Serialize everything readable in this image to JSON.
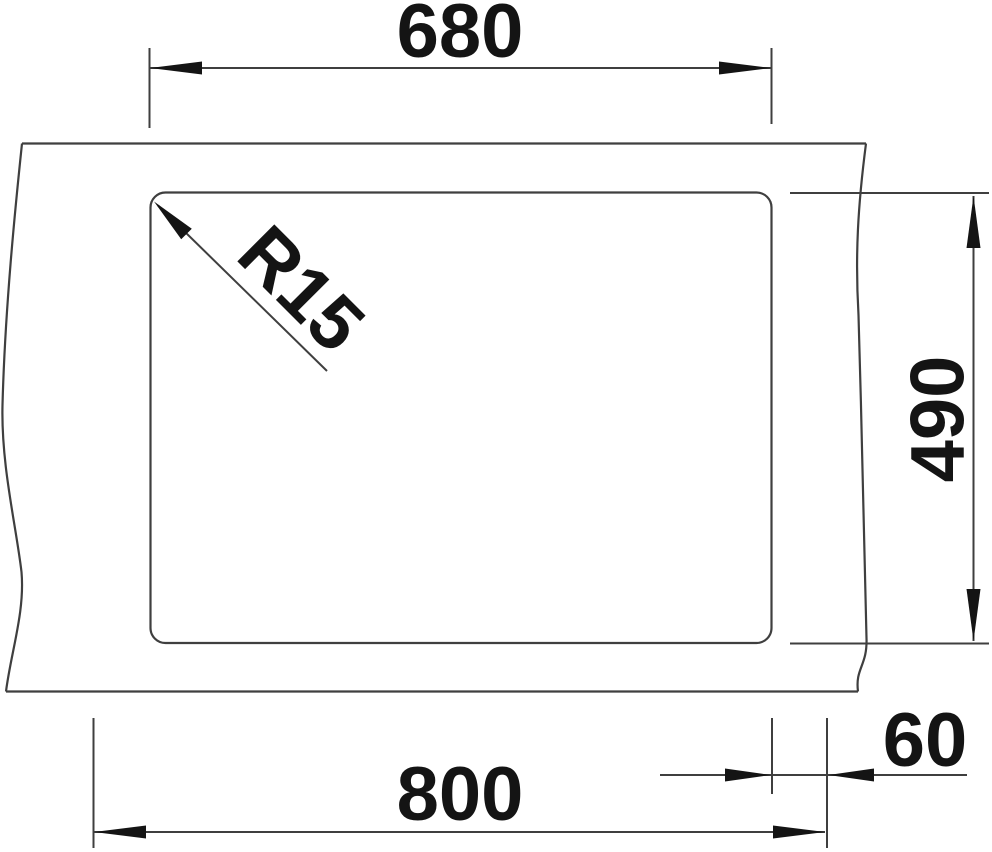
{
  "drawing": {
    "title": "sink-bowl-top-view-dimension-drawing",
    "colors": {
      "line": "#3f3f3f",
      "ink": "#141414",
      "background": "#ffffff"
    },
    "dimensions": {
      "bowl_width": {
        "label": "680"
      },
      "bowl_depth": {
        "label": "490"
      },
      "overall_width": {
        "label": "800"
      },
      "edge_offset": {
        "label": "60"
      },
      "corner_radius": {
        "label": "R15"
      }
    }
  }
}
